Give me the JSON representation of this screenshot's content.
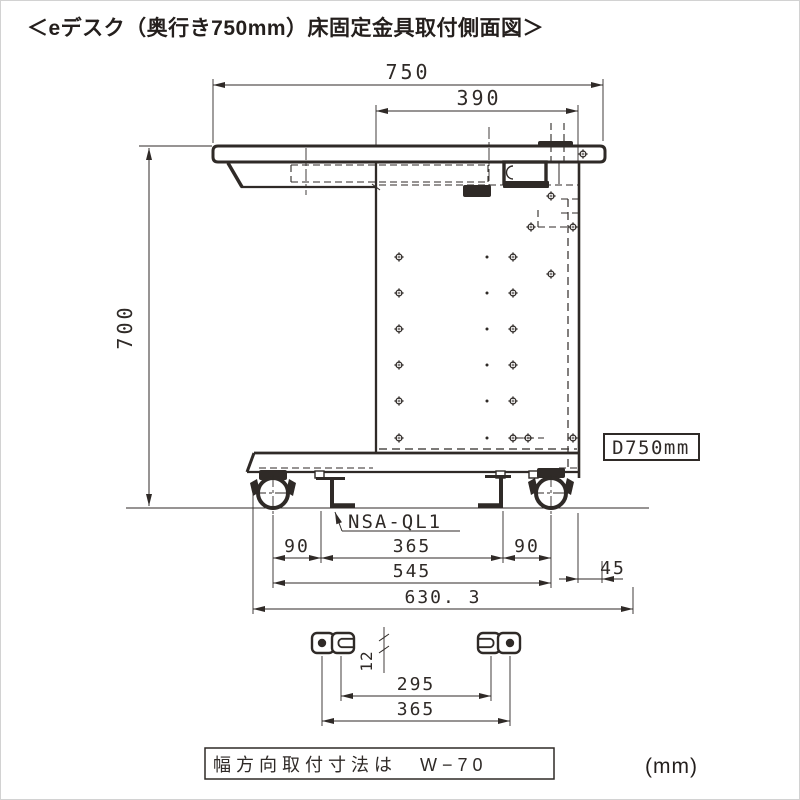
{
  "title": "＜eデスク（奥行き750mm）床固定金具取付側面図＞",
  "unit_label": "(mm)",
  "dims": {
    "depth_top": "750",
    "inner_top": "390",
    "height": "700",
    "left_offset": "90",
    "center_span": "365",
    "right_offset": "90",
    "base_span": "545",
    "rear_overhang": "45",
    "overall_depth": "630. 3"
  },
  "detail_dims": {
    "slot_offset": "12",
    "slot_span": "295",
    "hole_span": "365"
  },
  "labels": {
    "bracket_model": "NSA-QL1",
    "depth_badge": "D750mm",
    "width_note": "幅方向取付寸法は　W−70"
  },
  "colors": {
    "line": "#2f2a27",
    "background": "#ffffff"
  }
}
